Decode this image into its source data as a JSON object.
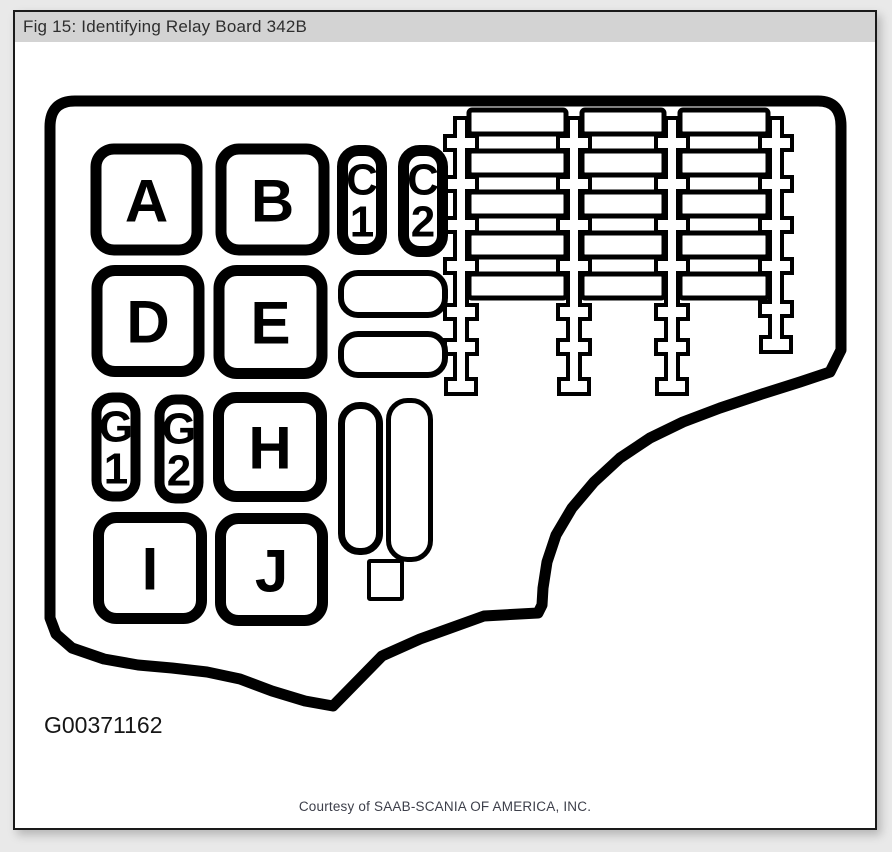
{
  "window": {
    "title": "Fig 15: Identifying Relay Board 342B"
  },
  "diagram": {
    "relays": {
      "a": "A",
      "b": "B",
      "c1": {
        "top": "C",
        "bottom": "1"
      },
      "c2": {
        "top": "C",
        "bottom": "2"
      },
      "d": "D",
      "e": "E",
      "g1": {
        "top": "G",
        "bottom": "1"
      },
      "g2": {
        "top": "G",
        "bottom": "2"
      },
      "h": "H",
      "i": "I",
      "j": "J"
    },
    "fuse_block": {
      "columns": 3,
      "rows": 5
    },
    "figure_code": "G00371162"
  },
  "footer": {
    "credit": "Courtesy of SAAB-SCANIA OF AMERICA, INC."
  },
  "colors": {
    "line": "#000000",
    "titlebar_bg": "#d3d3d3",
    "page_bg": "#e9e9e9"
  }
}
